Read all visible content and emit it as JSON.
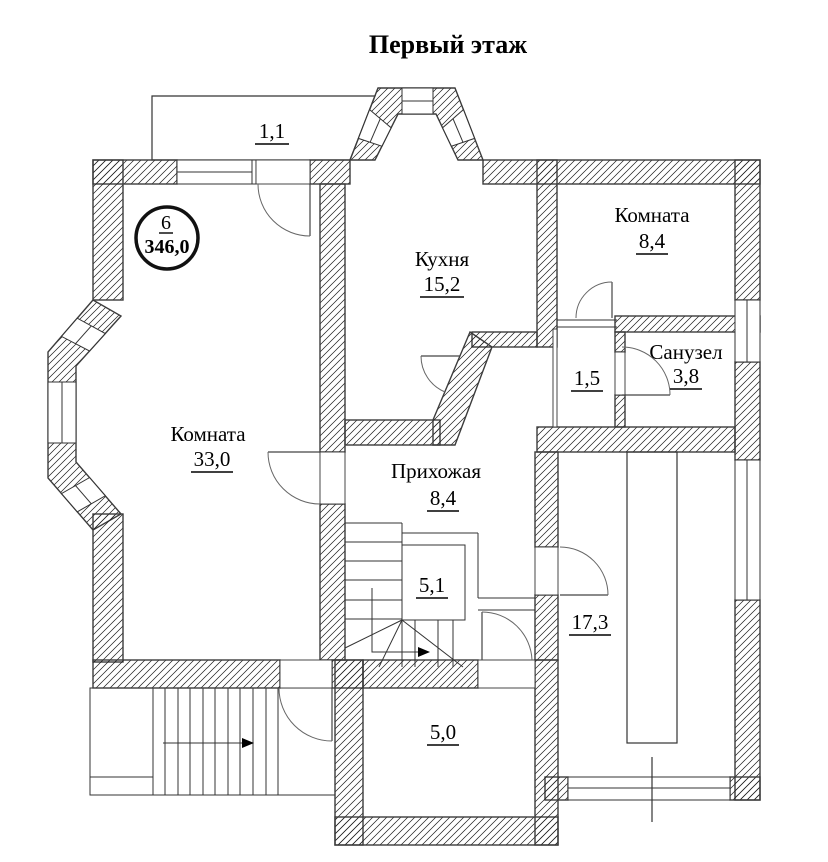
{
  "title": "Первый этаж",
  "floor_badge": {
    "number": "6",
    "area": "346,0"
  },
  "rooms": {
    "balcony_top": {
      "area": "1,1"
    },
    "kitchen": {
      "name": "Кухня",
      "area": "15,2"
    },
    "room_small": {
      "name": "Комната",
      "area": "8,4"
    },
    "bathroom": {
      "name": "Санузел",
      "area": "3,8"
    },
    "closet": {
      "area": "1,5"
    },
    "living_room": {
      "name": "Комната",
      "area": "33,0"
    },
    "hallway": {
      "name": "Прихожая",
      "area": "8,4"
    },
    "staircase": {
      "area": "5,1"
    },
    "back_room": {
      "area": "17,3"
    },
    "porch_bottom": {
      "area": "5,0"
    }
  }
}
